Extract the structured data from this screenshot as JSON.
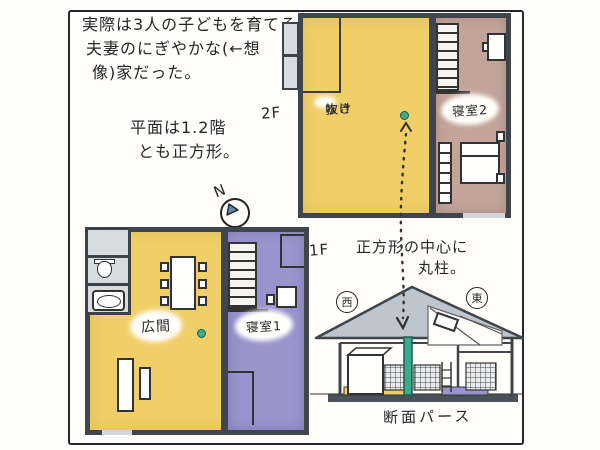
{
  "panel": {
    "intro_note": {
      "line1": "実際は3人の子どもを育てる",
      "line2": "夫妻のにぎやかな(←想",
      "line3": "像)家だった。"
    },
    "plan_note": {
      "line1": "平面は1.2階",
      "line2": "とも正方形。"
    },
    "north_label": "N",
    "floor2": {
      "label": "2F",
      "void_line1": "吹き",
      "void_line2": "抜け",
      "bedroom2": "寝室2"
    },
    "floor1": {
      "label": "1F",
      "hall": "広間",
      "bedroom1": "寝室1"
    },
    "column_note": {
      "line1": "正方形の中心に",
      "line2": "丸柱。"
    },
    "section": {
      "west": "西",
      "east": "東",
      "caption": "断面パース"
    },
    "colors": {
      "floor_yellow": "#f1cf68",
      "room_purple": "#9a94cd",
      "room_brown": "#c3a49b",
      "column_green": "#3fa98c",
      "roof_gray": "#bfc5cc",
      "wall_dark": "#3f454a",
      "service_gray": "#d9dcde"
    }
  }
}
